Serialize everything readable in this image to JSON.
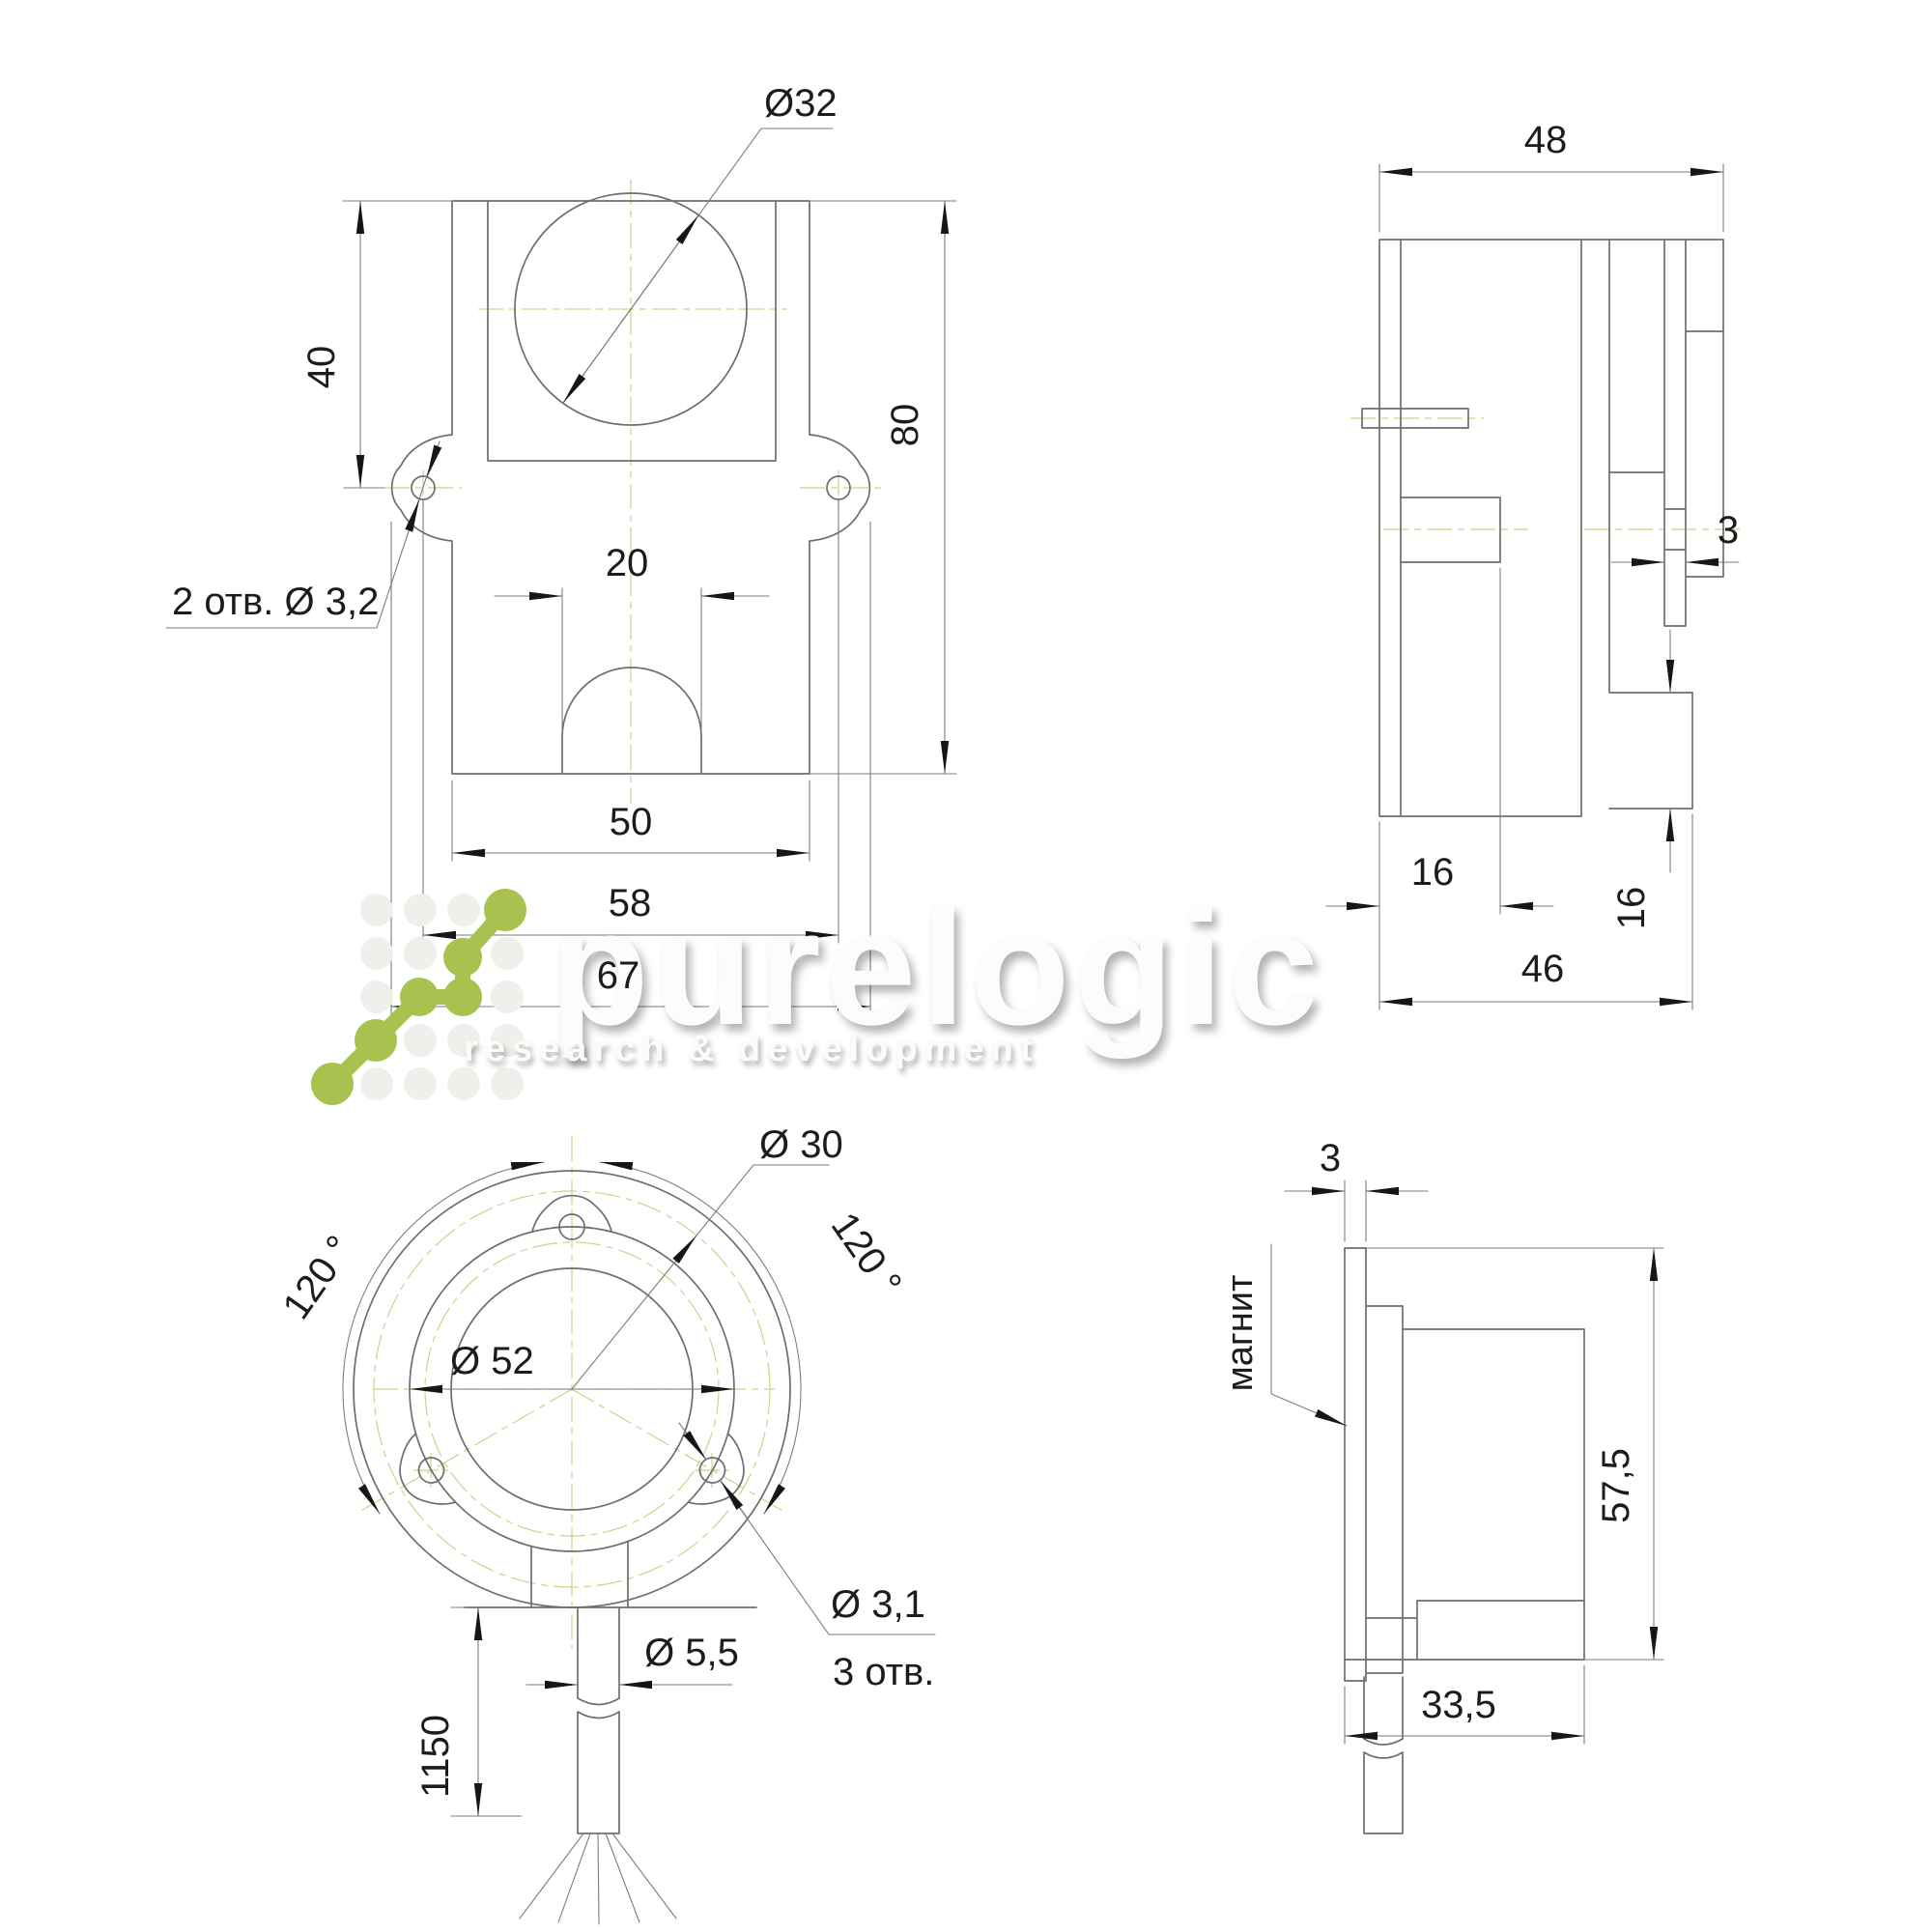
{
  "watermark": {
    "brand": "purelogic",
    "tagline": "research & development",
    "accent_color": "#a9c24f"
  },
  "front_view": {
    "dims": {
      "diameter": "Ø32",
      "top_offset": "40",
      "height": "80",
      "slot_width": "20",
      "body_width": "50",
      "hole_spacing": "58",
      "total_width": "67",
      "holes_note": "2 отв.  Ø 3,2"
    }
  },
  "side_view": {
    "dims": {
      "depth": "48",
      "magnet_gap": "3",
      "boss_height": "16",
      "flange_depth": "16",
      "body_depth": "46"
    }
  },
  "rear_view": {
    "dims": {
      "shaft_circle": "Ø 30",
      "angle_left": "120 °",
      "angle_right": "120 °",
      "ring_diameter": "Ø 52",
      "mount_hole": "Ø 3,1",
      "mount_holes_note": "3 отв.",
      "cable_diameter": "Ø 5,5",
      "cable_length": "1150"
    }
  },
  "magnet_view": {
    "dims": {
      "magnet_thickness": "3",
      "magnet_label": "магнит",
      "height": "57,5",
      "width": "33,5"
    }
  }
}
